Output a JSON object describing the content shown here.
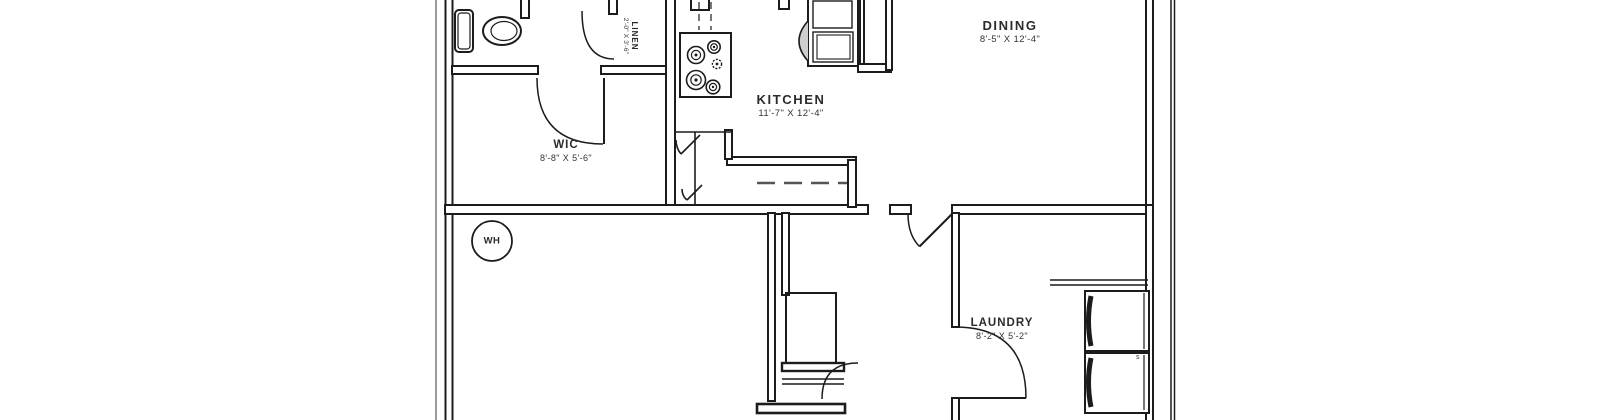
{
  "plan": {
    "type": "apartment-floor-plan-crop",
    "rooms": [
      {
        "name": "DINING",
        "dims": "8'-5\" X 12'-4\""
      },
      {
        "name": "KITCHEN",
        "dims": "11'-7\" X 12'-4\""
      },
      {
        "name": "WIC",
        "dims": "8'-8\" X 5'-6\""
      },
      {
        "name": "LINEN",
        "dims": "2'-0\" X 3'-6\""
      },
      {
        "name": "LAUNDRY",
        "dims": "8'-2\" X 5'-2\""
      }
    ],
    "water_heater": {
      "label": "WH"
    },
    "laundry_mark": "s",
    "fixtures": [
      "toilet",
      "cooktop-4-burners",
      "range-oven",
      "pantry-bifold-doors",
      "water-heater",
      "washer",
      "dryer",
      "laundry-shelf"
    ],
    "colors": {
      "wall_line": "#1c1c1c",
      "background": "#ffffff",
      "border_gray": "#9b9b9b",
      "dashed_line": "#555555",
      "appliance_shade": "#cfcfcf"
    }
  }
}
